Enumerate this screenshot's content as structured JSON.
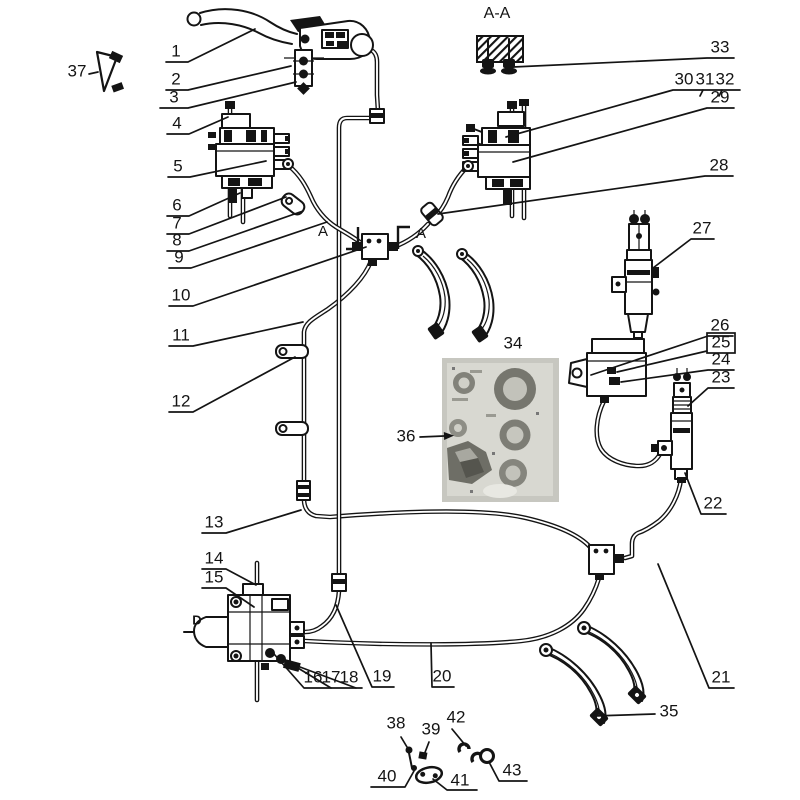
{
  "colors": {
    "line": "#141414",
    "background": "#ffffff",
    "photo_base": "#c7c7c0"
  },
  "section_labels": [
    {
      "id": "section-aa",
      "text": "A-A",
      "x": 497,
      "y": 14,
      "size": 16,
      "bold": false
    },
    {
      "id": "section-a-left",
      "text": "A",
      "x": 323,
      "y": 232,
      "size": 15,
      "bold": false
    },
    {
      "id": "section-a-right",
      "text": "A",
      "x": 421,
      "y": 234,
      "size": 15,
      "bold": false
    },
    {
      "id": "axis-d",
      "text": "D",
      "x": 197,
      "y": 621,
      "size": 13,
      "bold": true
    }
  ],
  "callouts": [
    {
      "id": "1",
      "text": "1",
      "x": 176,
      "y": 52,
      "line": [
        [
          166,
          62
        ],
        [
          188,
          62
        ],
        [
          255,
          29
        ]
      ]
    },
    {
      "id": "2",
      "text": "2",
      "x": 176,
      "y": 80,
      "line": [
        [
          166,
          90
        ],
        [
          188,
          90
        ],
        [
          291,
          66
        ]
      ]
    },
    {
      "id": "3",
      "text": "3",
      "x": 174,
      "y": 98,
      "line": [
        [
          160,
          108
        ],
        [
          188,
          108
        ],
        [
          296,
          82
        ]
      ]
    },
    {
      "id": "4",
      "text": "4",
      "x": 177,
      "y": 124,
      "line": [
        [
          167,
          134
        ],
        [
          189,
          134
        ],
        [
          228,
          117
        ]
      ]
    },
    {
      "id": "5",
      "text": "5",
      "x": 178,
      "y": 167,
      "line": [
        [
          168,
          177
        ],
        [
          190,
          177
        ],
        [
          266,
          161
        ]
      ]
    },
    {
      "id": "6",
      "text": "6",
      "x": 177,
      "y": 206,
      "line": [
        [
          167,
          216
        ],
        [
          189,
          216
        ],
        [
          240,
          193
        ]
      ]
    },
    {
      "id": "7",
      "text": "7",
      "x": 177,
      "y": 224,
      "line": [
        [
          167,
          234
        ],
        [
          189,
          234
        ],
        [
          286,
          197
        ]
      ]
    },
    {
      "id": "8",
      "text": "8",
      "x": 177,
      "y": 241,
      "line": [
        [
          167,
          251
        ],
        [
          189,
          251
        ],
        [
          303,
          211
        ]
      ]
    },
    {
      "id": "9",
      "text": "9",
      "x": 179,
      "y": 258,
      "line": [
        [
          169,
          268
        ],
        [
          191,
          268
        ],
        [
          327,
          222
        ]
      ]
    },
    {
      "id": "10",
      "text": "10",
      "x": 181,
      "y": 296,
      "line": [
        [
          169,
          306
        ],
        [
          193,
          306
        ],
        [
          366,
          247
        ]
      ]
    },
    {
      "id": "11",
      "text": "11",
      "x": 181,
      "y": 336,
      "line": [
        [
          169,
          346
        ],
        [
          193,
          346
        ],
        [
          303,
          322
        ]
      ]
    },
    {
      "id": "12",
      "text": "12",
      "x": 181,
      "y": 402,
      "line": [
        [
          169,
          412
        ],
        [
          193,
          412
        ],
        [
          295,
          357
        ]
      ]
    },
    {
      "id": "13",
      "text": "13",
      "x": 214,
      "y": 523,
      "line": [
        [
          202,
          533
        ],
        [
          226,
          533
        ],
        [
          301,
          510
        ]
      ]
    },
    {
      "id": "14",
      "text": "14",
      "x": 214,
      "y": 559,
      "line": [
        [
          202,
          569
        ],
        [
          226,
          569
        ],
        [
          256,
          585
        ]
      ]
    },
    {
      "id": "15",
      "text": "15",
      "x": 214,
      "y": 578,
      "line": [
        [
          202,
          588
        ],
        [
          226,
          588
        ],
        [
          254,
          607
        ]
      ]
    },
    {
      "id": "16",
      "text": "16",
      "x": 313,
      "y": 678,
      "line": [
        [
          362,
          688
        ],
        [
          304,
          688
        ],
        [
          274,
          654
        ]
      ]
    },
    {
      "id": "17",
      "text": "17",
      "x": 331,
      "y": 678,
      "line": [
        [
          331,
          688
        ],
        [
          283,
          659
        ]
      ]
    },
    {
      "id": "18",
      "text": "18",
      "x": 349,
      "y": 678,
      "line": [
        [
          356,
          688
        ],
        [
          292,
          664
        ]
      ]
    },
    {
      "id": "19",
      "text": "19",
      "x": 382,
      "y": 677,
      "line": [
        [
          394,
          687
        ],
        [
          372,
          687
        ],
        [
          336,
          605
        ]
      ]
    },
    {
      "id": "20",
      "text": "20",
      "x": 442,
      "y": 677,
      "line": [
        [
          454,
          687
        ],
        [
          432,
          687
        ],
        [
          431,
          643
        ]
      ]
    },
    {
      "id": "21",
      "text": "21",
      "x": 721,
      "y": 678,
      "line": [
        [
          734,
          688
        ],
        [
          709,
          688
        ],
        [
          658,
          564
        ]
      ]
    },
    {
      "id": "22",
      "text": "22",
      "x": 713,
      "y": 504,
      "line": [
        [
          726,
          514
        ],
        [
          701,
          514
        ],
        [
          685,
          473
        ]
      ]
    },
    {
      "id": "23",
      "text": "23",
      "x": 721,
      "y": 378,
      "line": [
        [
          734,
          388
        ],
        [
          708,
          388
        ],
        [
          688,
          406
        ]
      ]
    },
    {
      "id": "24",
      "text": "24",
      "x": 721,
      "y": 360,
      "line": [
        [
          734,
          370
        ],
        [
          708,
          370
        ],
        [
          621,
          382
        ]
      ]
    },
    {
      "id": "25",
      "text": "25",
      "x": 721,
      "y": 343,
      "box": [
        707,
        333,
        28,
        20
      ],
      "line": [
        [
          707,
          351
        ],
        [
          617,
          372
        ]
      ]
    },
    {
      "id": "26",
      "text": "26",
      "x": 720,
      "y": 326,
      "line": [
        [
          733,
          336
        ],
        [
          708,
          336
        ],
        [
          591,
          375
        ]
      ]
    },
    {
      "id": "27",
      "text": "27",
      "x": 702,
      "y": 229,
      "line": [
        [
          714,
          239
        ],
        [
          691,
          239
        ],
        [
          653,
          268
        ]
      ]
    },
    {
      "id": "28",
      "text": "28",
      "x": 719,
      "y": 166,
      "line": [
        [
          733,
          176
        ],
        [
          705,
          176
        ],
        [
          438,
          214
        ]
      ]
    },
    {
      "id": "29",
      "text": "29",
      "x": 720,
      "y": 98,
      "line": [
        [
          734,
          108
        ],
        [
          707,
          108
        ],
        [
          513,
          162
        ]
      ]
    },
    {
      "id": "30",
      "text": "30",
      "x": 684,
      "y": 80,
      "line": [
        [
          740,
          90
        ],
        [
          673,
          90
        ],
        [
          506,
          137
        ]
      ]
    },
    {
      "id": "31",
      "text": "31",
      "x": 705,
      "y": 80,
      "line": [
        [
          703,
          90
        ],
        [
          700,
          96
        ]
      ]
    },
    {
      "id": "32",
      "text": "32",
      "x": 725,
      "y": 80,
      "line": [
        [
          722,
          90
        ],
        [
          719,
          96
        ]
      ]
    },
    {
      "id": "33",
      "text": "33",
      "x": 720,
      "y": 48,
      "line": [
        [
          734,
          58
        ],
        [
          707,
          58
        ],
        [
          513,
          67
        ]
      ]
    },
    {
      "id": "34",
      "text": "34",
      "x": 513,
      "y": 344,
      "line": []
    },
    {
      "id": "35",
      "text": "35",
      "x": 669,
      "y": 712,
      "line": [
        [
          655,
          714
        ],
        [
          594,
          716
        ]
      ]
    },
    {
      "id": "36",
      "text": "36",
      "x": 406,
      "y": 437,
      "line": [
        [
          420,
          437
        ],
        [
          444,
          436
        ]
      ],
      "arrow": true
    },
    {
      "id": "37",
      "text": "37",
      "x": 77,
      "y": 72,
      "line": [
        [
          89,
          74
        ],
        [
          98,
          72
        ]
      ]
    },
    {
      "id": "38",
      "text": "38",
      "x": 396,
      "y": 724,
      "line": [
        [
          401,
          737
        ],
        [
          410,
          752
        ]
      ]
    },
    {
      "id": "39",
      "text": "39",
      "x": 431,
      "y": 730,
      "line": [
        [
          429,
          742
        ],
        [
          424,
          755
        ]
      ]
    },
    {
      "id": "40",
      "text": "40",
      "x": 387,
      "y": 777,
      "line": [
        [
          371,
          787
        ],
        [
          405,
          787
        ],
        [
          414,
          771
        ]
      ]
    },
    {
      "id": "41",
      "text": "41",
      "x": 460,
      "y": 781,
      "line": [
        [
          477,
          790
        ],
        [
          447,
          790
        ],
        [
          433,
          779
        ]
      ]
    },
    {
      "id": "42",
      "text": "42",
      "x": 456,
      "y": 718,
      "line": [
        [
          452,
          729
        ],
        [
          466,
          746
        ]
      ]
    },
    {
      "id": "43",
      "text": "43",
      "x": 512,
      "y": 771,
      "line": [
        [
          527,
          781
        ],
        [
          499,
          781
        ],
        [
          489,
          762
        ]
      ]
    }
  ]
}
